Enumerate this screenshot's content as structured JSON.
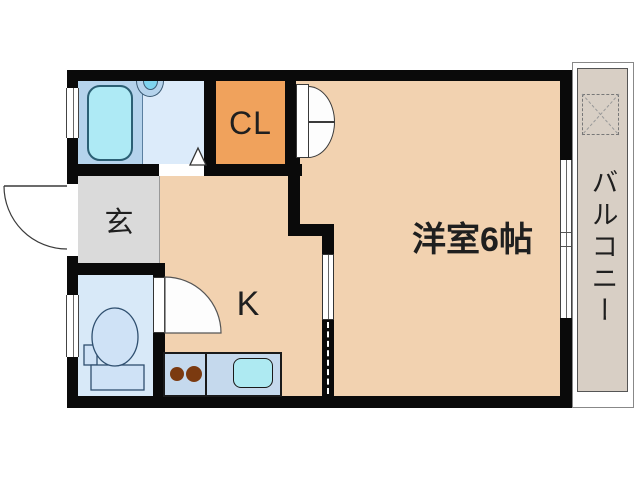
{
  "plan": {
    "type": "apartment-floor-plan",
    "labels": {
      "western_room": "洋室6帖",
      "kitchen": "K",
      "closet": "CL",
      "entrance": "玄",
      "balcony": "バルコニー"
    },
    "fixtures": [
      "bathtub",
      "washbasin",
      "bathroom-door",
      "entrance-door",
      "toilet",
      "toilet-tank",
      "paper-holder",
      "kitchen-counter",
      "stove-burners",
      "kitchen-sink",
      "sliding-door",
      "closet-double-door",
      "washing-machine-area",
      "balcony-window",
      "bathroom-window",
      "toilet-window"
    ],
    "colors": {
      "wall": "#0a0a0a",
      "floor": "#f2d2b0",
      "closet": "#f0a25c",
      "entrance_floor": "#dadada",
      "bathroom": "#dcebfa",
      "bathtub": "#aeeaf5",
      "bathtub_deck": "#b5d3ec",
      "toilet_room": "#d8e9f8",
      "toilet_fixture": "#cfe2f6",
      "kitchen_counter": "#c5d9ed",
      "kitchen_sink": "#aeeaf2",
      "stove_burner": "#7b3a10",
      "balcony_floor": "#d8cfc5"
    }
  }
}
